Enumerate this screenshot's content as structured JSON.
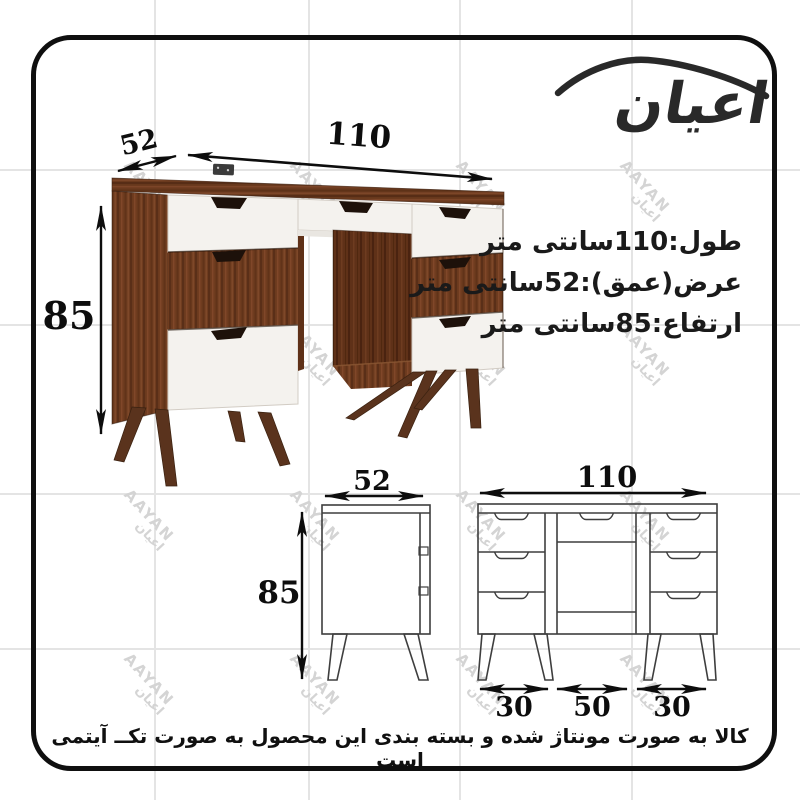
{
  "brand": {
    "logo_text": "اعیان"
  },
  "watermark": {
    "latin": "AAYAN",
    "farsi": "اعیان"
  },
  "specs": {
    "length": "طول:110سانتی متر",
    "depth": "عرض(عمق):52سانتی متر",
    "height": "ارتفاع:85سانتی متر"
  },
  "dimensions": {
    "width_cm": "110",
    "depth_cm": "52",
    "height_cm": "85",
    "pedestal_left_cm": "30",
    "kneehole_cm": "50",
    "pedestal_right_cm": "30"
  },
  "footer": {
    "note": "کالا به صورت مونتاژ شده و بسته بندی این محصول  به صورت تکــ آیتمی است"
  },
  "colors": {
    "wood": "#6f3c1f",
    "wood_dark": "#5f3118",
    "drawer_white": "#f4f2ee",
    "drawing_line": "#3e3e3e",
    "ink": "#0d0d0d",
    "watermark": "#d4d4d4",
    "grid": "#e4e4e4",
    "logo": "#292929"
  }
}
